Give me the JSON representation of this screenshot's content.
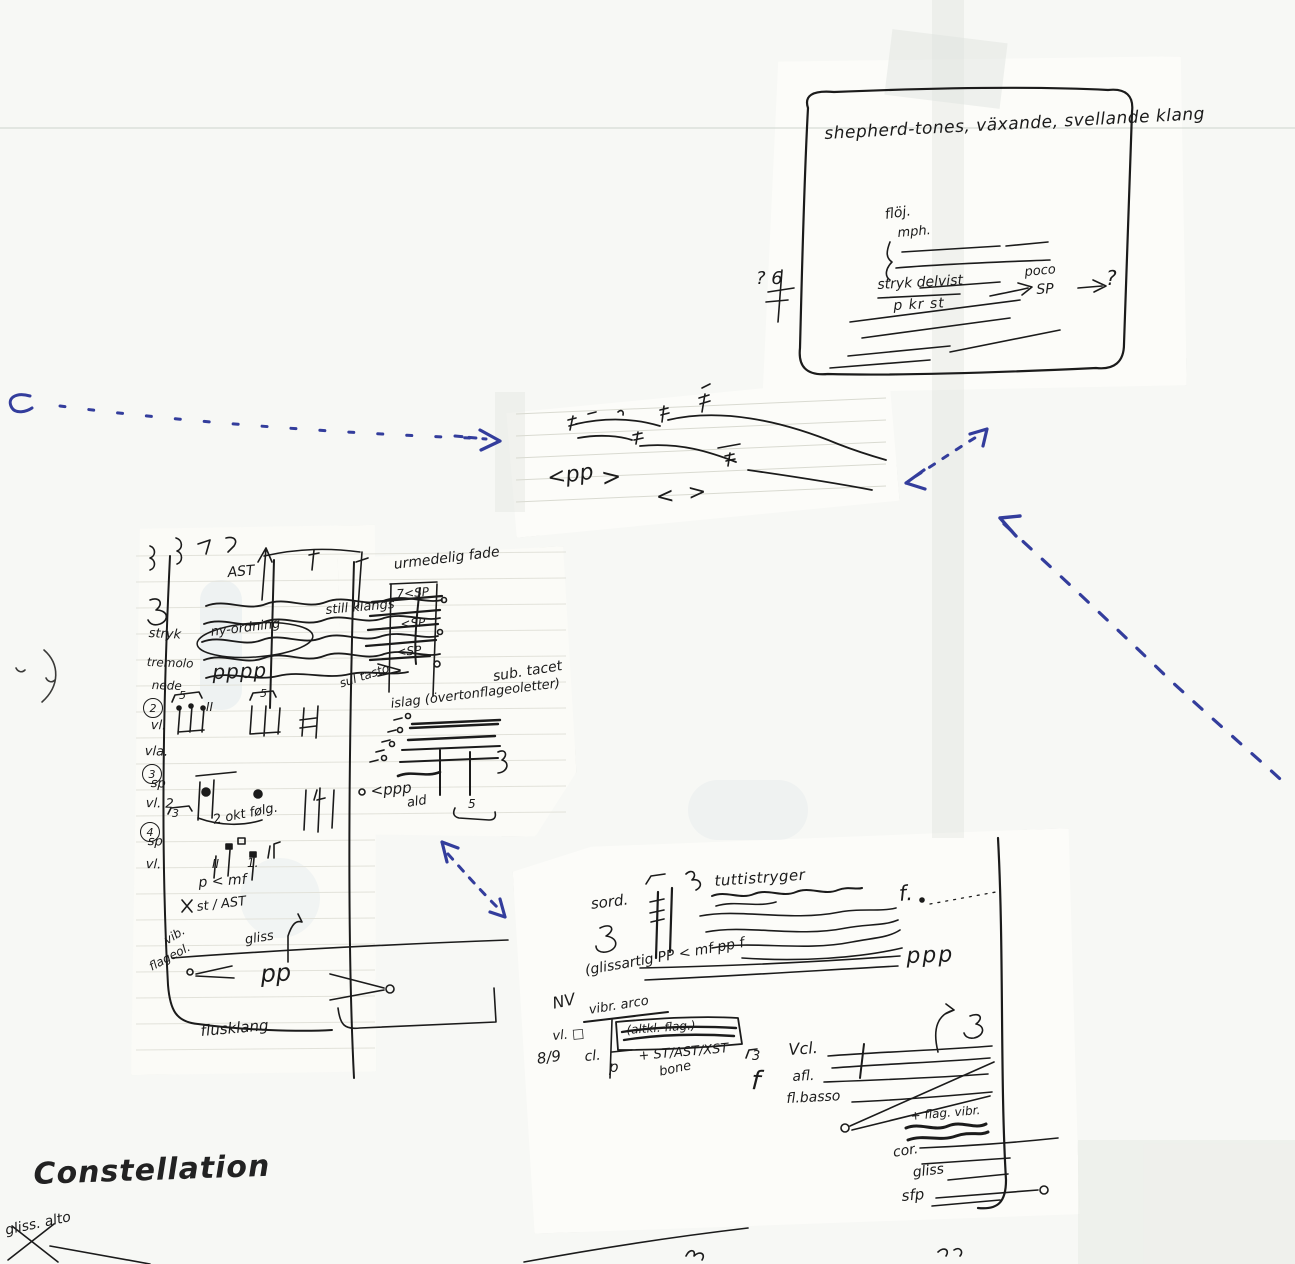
{
  "page": {
    "title": "Constellation",
    "crossed_note": "gliss. alto"
  },
  "shepherd_box": {
    "title": "shepherd-tones, växande, svellande klang",
    "floej": "flöj.",
    "mph": "mph.",
    "stryk_delvist": "stryk delvist",
    "pkrst": "p kr st",
    "poco": "poco",
    "sp": "SP",
    "question_right": "?",
    "question_left": "? 6"
  },
  "staff_fragment": {
    "cresc_pp": "<pp",
    "decresc": ">",
    "hairpin_open": "<",
    "hairpin_close": ">"
  },
  "left_fragment": {
    "ast": "AST",
    "wavy_label": "still klangs",
    "ny_ordning": "ny-ordning",
    "stryk": "stryk",
    "tremolo": "tremolo",
    "nede": "nede",
    "pppp": "pppp",
    "fade_label": "urmedelig fade",
    "sp_mark_1": "7<SP",
    "sp_mark_2": "<SP",
    "sp_mark_3": "<SP",
    "sub_tacet": "sub. tacet",
    "islag": "islag (övertonflageoletter)",
    "ppp_small": "<ppp",
    "ald": "ald",
    "tuplet5_low": "5",
    "sec2_num": "2",
    "sec2_vl": "vl.",
    "sec2_vla": "vla.",
    "tuplet5_a": "5",
    "roman_2a": "II",
    "tuplet5_b": "5",
    "sul_tasto": "sul tasto",
    "sec3_num": "3",
    "sec3_sp": "sp",
    "sec3_vl2": "vl. 2",
    "tuplet3": "3",
    "okt_folg": "2 okt følg.",
    "sec4_num": "4",
    "sec4_sp": "sp",
    "sec4_vl": "vl.",
    "roman_2b": "II",
    "one": "1.",
    "p_mf": "p < mf",
    "st_ast": "st / AST",
    "vib": "vib.",
    "flageol": "flageol.",
    "gliss": "gliss",
    "pp": "pp",
    "flusklang": "flusklang"
  },
  "bottom_fragment": {
    "sord": "sord.",
    "tutti": "tuttistryger",
    "f_dot": "f.",
    "ppp": "ppp",
    "glissartig": "(glissartig PP < mf pp f",
    "nv": "NV",
    "vibr_arco": "vibr. arco",
    "vl_square": "vl. □",
    "eight_nine": "8/9",
    "cl": "cl.",
    "altkl_flag": "(altkl. flag.)",
    "st_ast_xst": "+ ST/AST/XST",
    "bone": "bone",
    "p": "p",
    "tuplet3": "3",
    "f_tall": "f",
    "vcl": "Vcl.",
    "afl": "afl.",
    "fl_basso": "fl.basso",
    "flag_vibr": "+ flag. vibr.",
    "cor": "cor.",
    "gliss": "gliss",
    "sfp": "sfp"
  },
  "colors": {
    "ink": "#1b1b1b",
    "blue_pen": "#333d9c",
    "paper": "#f7f8f5",
    "fragment": "#fcfcf9",
    "rule": "#d9dad1"
  }
}
